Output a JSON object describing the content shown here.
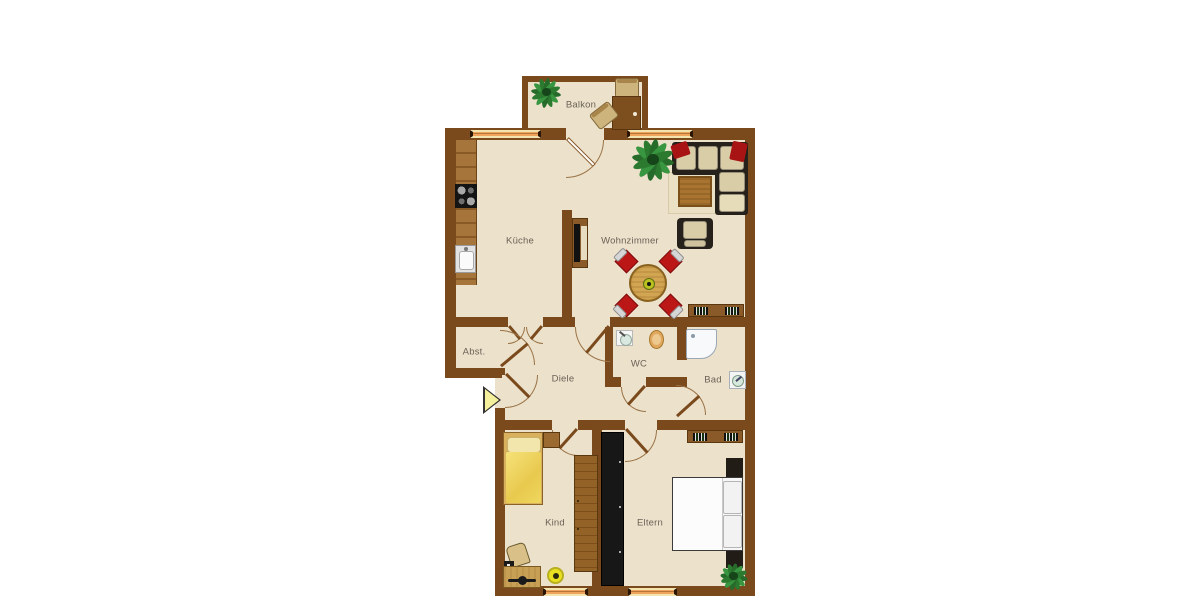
{
  "meta": {
    "type": "apartment-floorplan",
    "language": "de",
    "style": "top-down furnished plan on white background"
  },
  "colors": {
    "wall": "#7a4a1d",
    "floor": "#ece1ca",
    "outside": "#ffffff",
    "window_glass": "#efa35b",
    "window_frame": "#f3e3ae",
    "door_arc": "#9a7347",
    "label_text": "#6b6258",
    "accent_red": "#b51717",
    "plant_green": "#2c7a30",
    "wood_light": "#c8a055",
    "wood_mid": "#9a6a30",
    "black_furniture": "#171717",
    "bed_yellow": "#f2d96a",
    "entrance_arrow": "#f5f09c"
  },
  "rooms": [
    {
      "id": "balkon",
      "label": "Balkon",
      "furniture": [
        "plant",
        "bistro-table",
        "chair",
        "chair-tilted"
      ]
    },
    {
      "id": "kueche",
      "label": "Küche",
      "furniture": [
        "kitchen-counter",
        "stove",
        "kitchen-sink"
      ]
    },
    {
      "id": "wohnzimmer",
      "label": "Wohnzimmer",
      "furniture": [
        "corner-sofa",
        "red-pillows",
        "rug",
        "coffee-table",
        "armchair",
        "round-dining-table",
        "four-red-chairs",
        "plant",
        "tv-lowboard",
        "sideboard-with-books"
      ]
    },
    {
      "id": "abstellraum",
      "label": "Abst.",
      "furniture": []
    },
    {
      "id": "diele",
      "label": "Diele",
      "furniture": []
    },
    {
      "id": "wc",
      "label": "WC",
      "furniture": [
        "hand-basin",
        "toilet"
      ]
    },
    {
      "id": "bad",
      "label": "Bad",
      "furniture": [
        "shower",
        "washing-machine"
      ]
    },
    {
      "id": "kind",
      "label": "Kind",
      "furniture": [
        "single-bed-yellow",
        "nightstand",
        "wardrobe-wood",
        "desk",
        "desk-chair",
        "desk-lamp",
        "stool-yellow"
      ]
    },
    {
      "id": "eltern",
      "label": "Eltern",
      "furniture": [
        "double-bed",
        "headboard",
        "wardrobe-black",
        "sideboard-with-books",
        "plant"
      ]
    }
  ],
  "openings": {
    "windows": [
      "top-wall-left",
      "top-wall-right",
      "bottom-wall-kind",
      "bottom-wall-eltern"
    ],
    "doors": [
      "balcony-door",
      "kitchen-double-door",
      "livingroom-door",
      "storage-door",
      "entrance-door",
      "wc-door",
      "bath-door",
      "kind-door",
      "eltern-door"
    ]
  },
  "entrance": {
    "symbol": "arrow-right",
    "meaning": "apartment entrance"
  }
}
